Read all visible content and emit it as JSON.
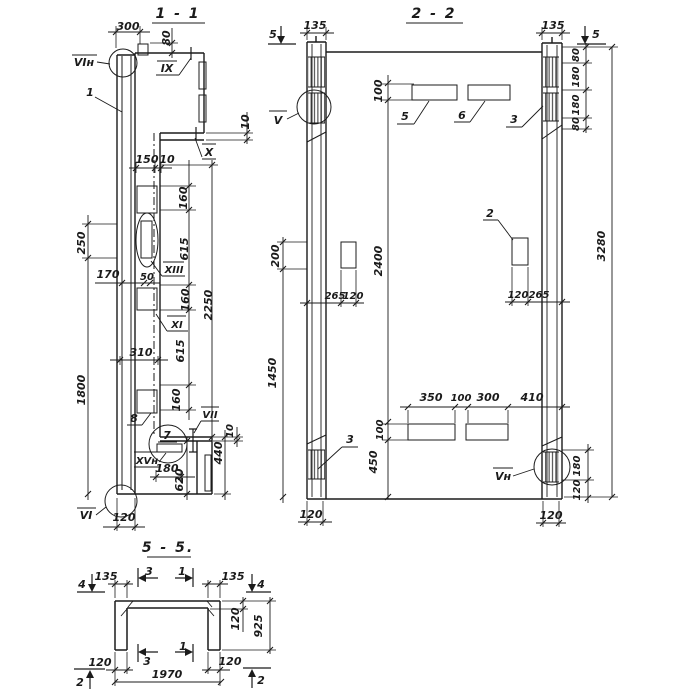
{
  "meta": {
    "background": "#ffffff",
    "ink": "#1b1b1b"
  },
  "s11": {
    "title": "1 - 1",
    "labels": {
      "vi_top": "VIн",
      "one": "1",
      "ix": "IX",
      "x": "X",
      "xiii": "XIII",
      "xi": "XI",
      "eight": "8",
      "seven": "7",
      "vii": "VII",
      "xv": "XVн",
      "vi": "VI"
    },
    "dims": {
      "d300": "300",
      "d80": "80",
      "d10a": "10",
      "d150": "150",
      "d10b": "10",
      "d160a": "160",
      "d615a": "615",
      "d160b": "160",
      "d615b": "615",
      "d160c": "160",
      "d2250": "2250",
      "d250": "250",
      "d1800": "1800",
      "d170": "170",
      "d50": "50",
      "d310": "310",
      "d10c": "10",
      "d440": "440",
      "d180": "180",
      "d620": "620",
      "d120": "120"
    }
  },
  "s22": {
    "title": "2 - 2",
    "markers": {
      "five_l": "5",
      "five_r": "5"
    },
    "labels": {
      "v": "V",
      "five": "5",
      "six": "6",
      "three_r": "3",
      "two": "2",
      "three_l": "3",
      "vn": "Vн"
    },
    "dims": {
      "d135l": "135",
      "d135r": "135",
      "d80a": "80",
      "d180a": "180",
      "d180b": "180",
      "d80b": "80",
      "d100a": "100",
      "d200": "200",
      "d2400": "2400",
      "d265a": "265",
      "d120a": "120",
      "d120b": "120",
      "d265b": "265",
      "d3280": "3280",
      "d1450": "1450",
      "d100b": "100",
      "d450": "450",
      "d350": "350",
      "d100c": "100",
      "d300": "300",
      "d410": "410",
      "d180c": "180",
      "d120c": "120",
      "d120d": "120",
      "d120e": "120"
    }
  },
  "s55": {
    "title": "5 - 5.",
    "markers": {
      "four_l": "4",
      "four_r": "4",
      "three_t": "3",
      "one_t": "1",
      "three_b": "3",
      "one_b": "1",
      "two_l": "2",
      "two_r": "2"
    },
    "dims": {
      "d135l": "135",
      "d135r": "135",
      "d120rot": "120",
      "d925": "925",
      "d120l": "120",
      "d120r": "120",
      "d1970": "1970"
    }
  }
}
